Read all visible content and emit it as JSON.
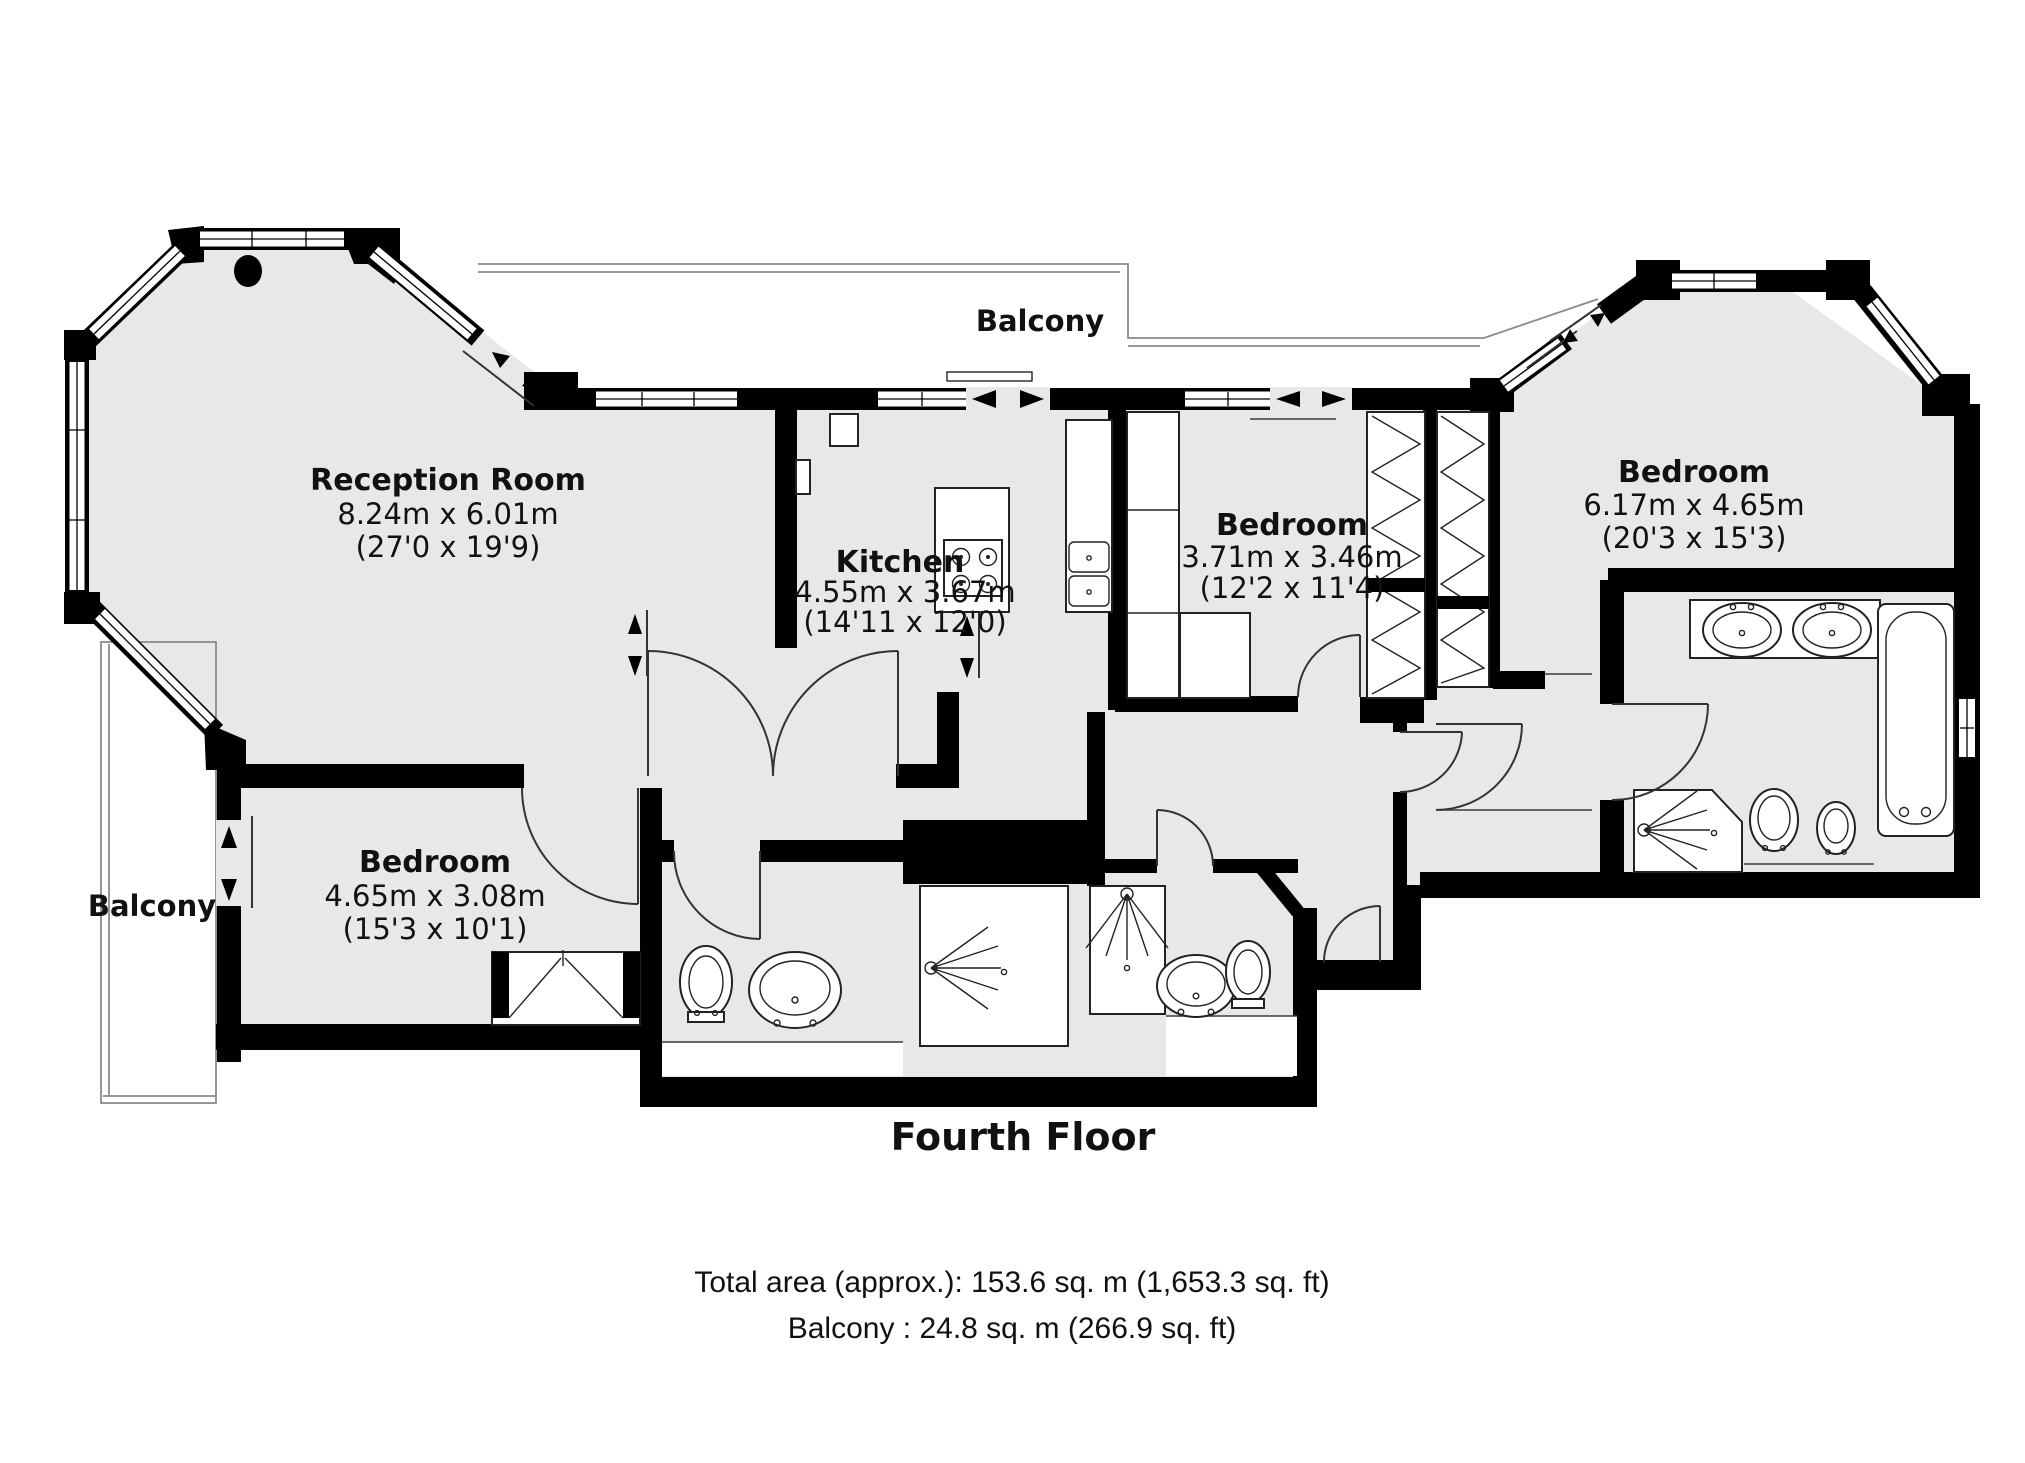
{
  "floor_plan": {
    "title": "Fourth Floor",
    "balcony_top": {
      "label": "Balcony"
    },
    "balcony_left": {
      "label": "Balcony"
    },
    "rooms": {
      "reception": {
        "name": "Reception Room",
        "dims_m": "8.24m x 6.01m",
        "dims_ft": "(27'0 x 19'9)"
      },
      "kitchen": {
        "name": "Kitchen",
        "dims_m": "4.55m x 3.67m",
        "dims_ft": "(14'11 x 12'0)"
      },
      "bedroom_middle": {
        "name": "Bedroom",
        "dims_m": "3.71m x 3.46m",
        "dims_ft": "(12'2 x 11'4)"
      },
      "bedroom_right": {
        "name": "Bedroom",
        "dims_m": "6.17m x 4.65m",
        "dims_ft": "(20'3 x 15'3)"
      },
      "bedroom_left": {
        "name": "Bedroom",
        "dims_m": "4.65m x 3.08m",
        "dims_ft": "(15'3 x 10'1)"
      }
    },
    "totals": {
      "total_area": "Total area (approx.): 153.6 sq. m (1,653.3 sq. ft)",
      "balcony_area": "Balcony : 24.8 sq. m (266.9 sq. ft)"
    }
  },
  "colors": {
    "floor": "#e8e8e8",
    "wall": "#000000",
    "balcony_outline": "#8a8a8a",
    "background": "#ffffff"
  }
}
